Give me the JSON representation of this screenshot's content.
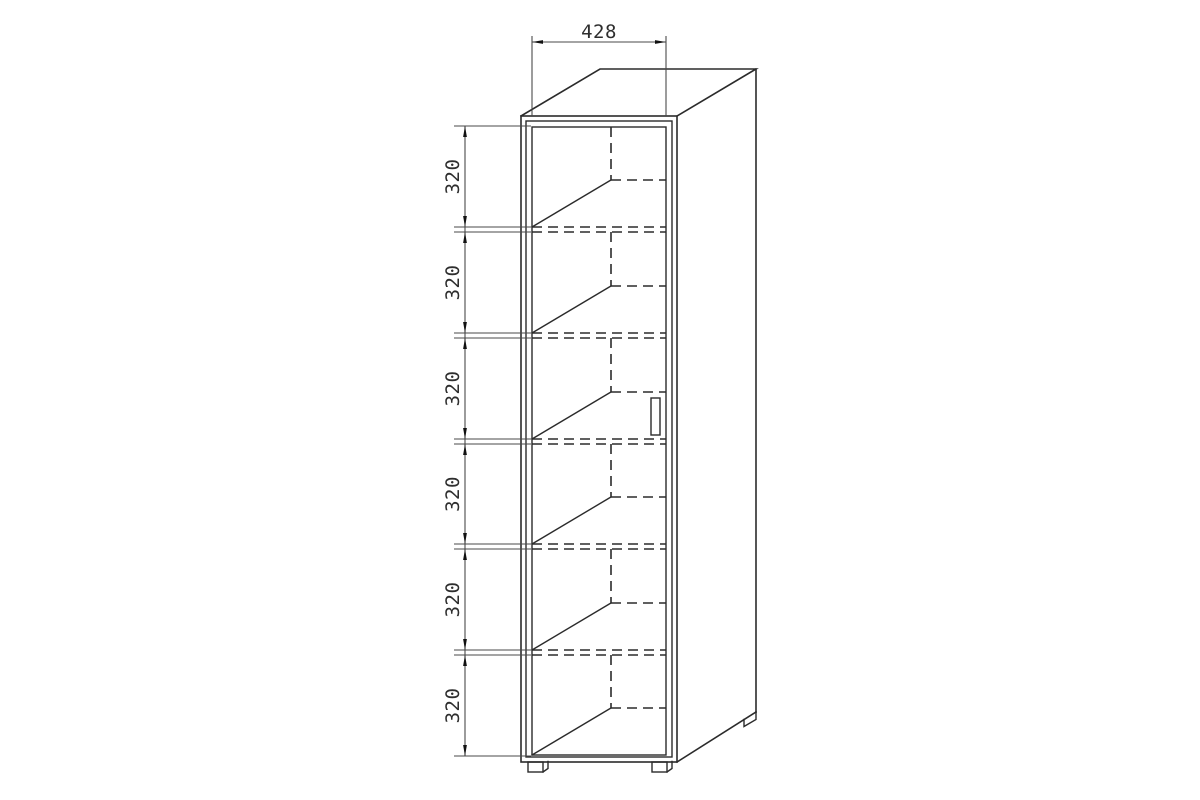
{
  "dimensions": {
    "width": "428",
    "sections": [
      "320",
      "320",
      "320",
      "320",
      "320",
      "320"
    ]
  }
}
